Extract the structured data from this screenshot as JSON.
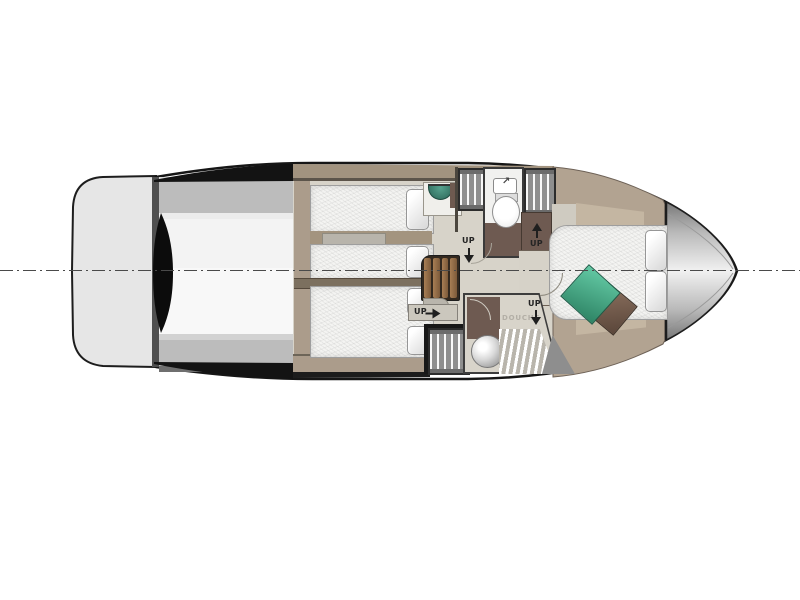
{
  "diagram": {
    "type": "yacht lower-deck floor plan",
    "orientation": "bow right, stern left",
    "labels": {
      "up": "UP",
      "shower_room_label": "DOUCHE"
    },
    "icons": {
      "faucet_arrow": "↗"
    },
    "centerline": {
      "style": "dash-dot",
      "color": "#4a4a4a"
    },
    "areas": {
      "swim_platform": {
        "name": "swim platform"
      },
      "cockpit": {
        "name": "aft deck / engine space"
      },
      "twin_cabin": {
        "name": "twin guest cabin",
        "beds": 2,
        "features": [
          "two single berths",
          "pillows",
          "nightstand shelf",
          "teal vanity washbasin"
        ]
      },
      "double_cabin": {
        "name": "guest double cabin",
        "beds": 1,
        "features": [
          "double berth",
          "two pillows"
        ]
      },
      "head_compartment": {
        "name": "toilet compartment",
        "fixtures": [
          "washbasin",
          "toilet"
        ]
      },
      "shower_room": {
        "name": "shower room",
        "fixtures": [
          "shower head",
          "slatted bench"
        ]
      },
      "hanging_lockers": 3,
      "stairway": {
        "name": "companionway steps",
        "treads": 4
      },
      "master_cabin": {
        "name": "bow master cabin",
        "beds": 1,
        "features": [
          "island double berth",
          "two pillows",
          "teal cushion",
          "brown cushion"
        ]
      },
      "bow_deck": {
        "name": "foredeck"
      }
    },
    "arrows": [
      {
        "label": "UP",
        "direction": "down",
        "location": "twin cabin entry"
      },
      {
        "label": "UP",
        "direction": "right",
        "location": "double cabin entry"
      },
      {
        "label": "UP",
        "direction": "up",
        "location": "master cabin entry top"
      },
      {
        "label": "UP",
        "direction": "down",
        "location": "master cabin entry bottom"
      }
    ],
    "colors": {
      "hull_outline": "#161616",
      "wood_trim": "#b2a391",
      "cabin_floor": "#d6d2c8",
      "mattress": "#f4f4f2",
      "wet_area_brown": "#6e5a51",
      "stair_wood": "#9c7450",
      "teal_cushion": "#3f9d7c",
      "brown_cushion": "#74594a",
      "vanity_sink_teal": "#2f7263",
      "platform_gray": "#e6e6e6",
      "locker_gray": "#8e8e8e"
    }
  }
}
